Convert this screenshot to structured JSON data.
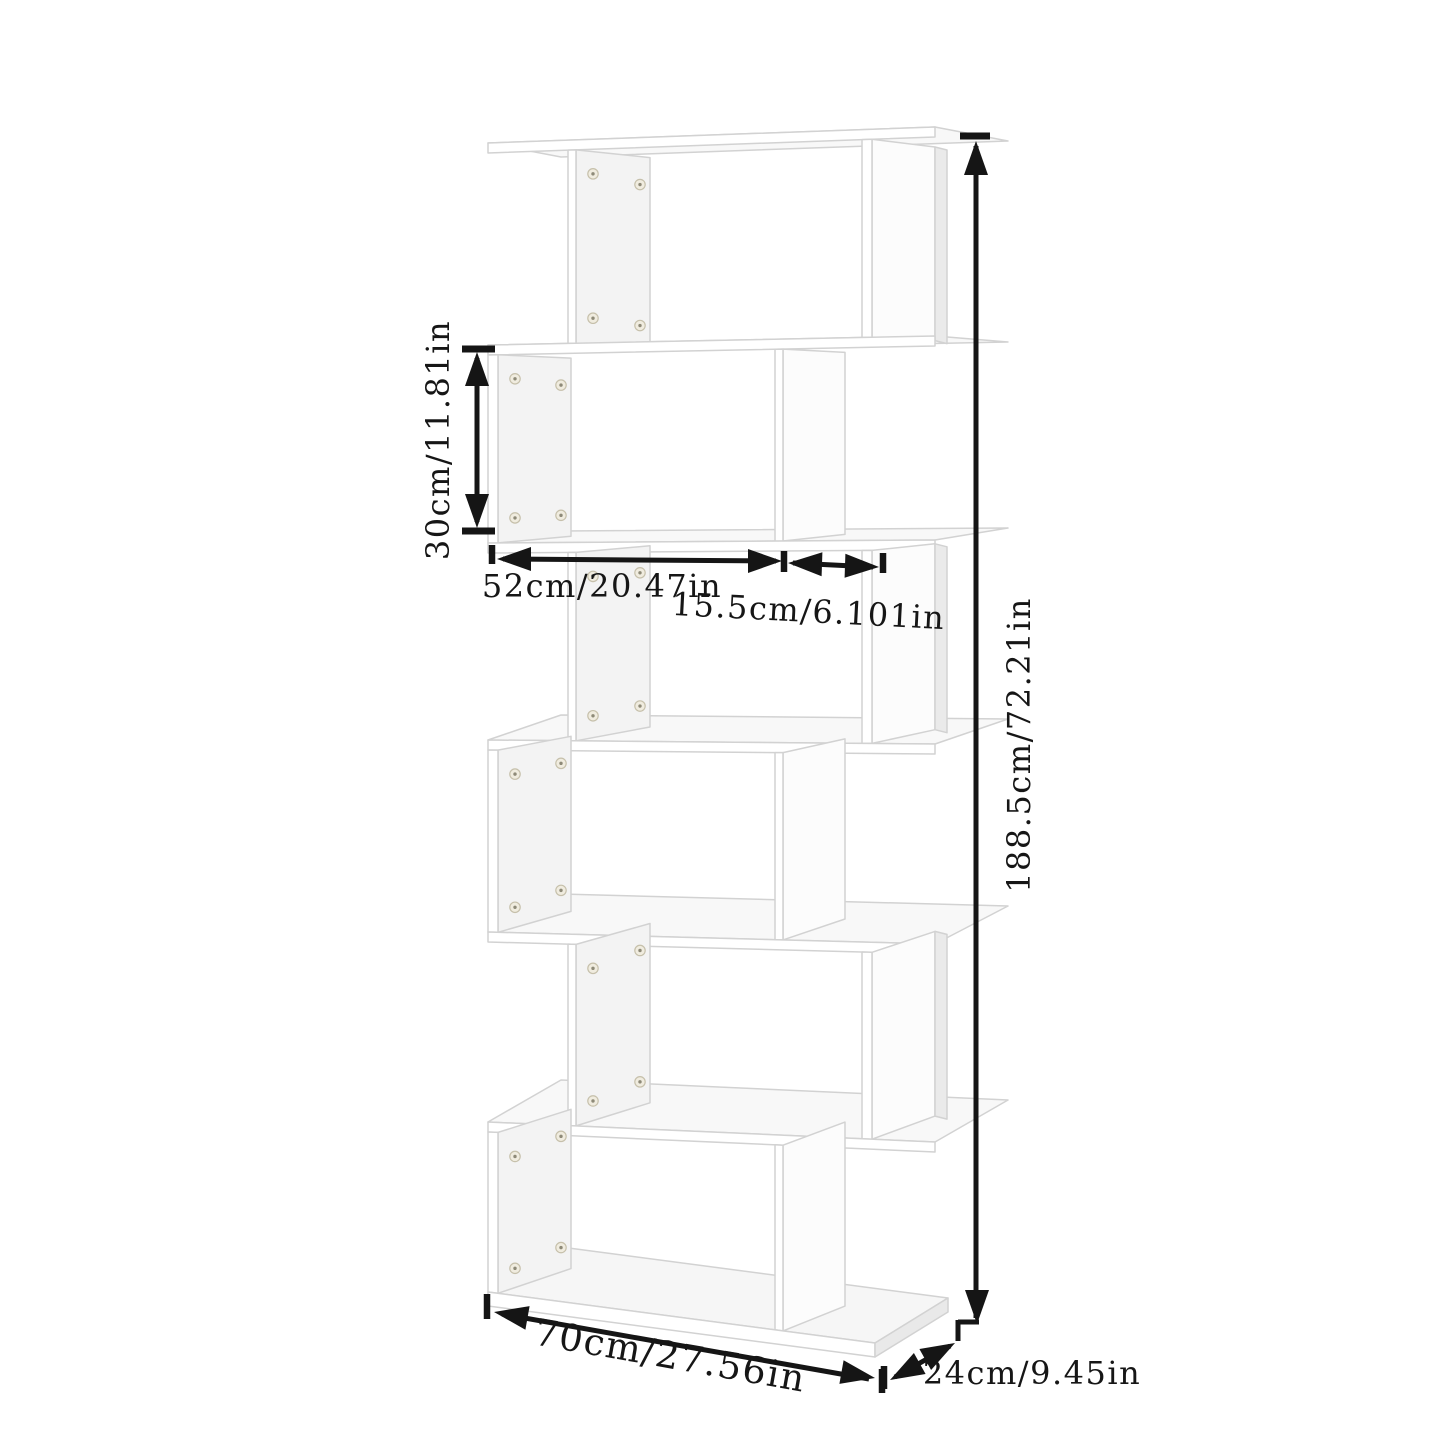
{
  "diagram": {
    "type": "product-dimension-diagram",
    "product": "s-shaped-bookcase",
    "tier_count": 6,
    "dimensions": {
      "total_height": "188.5cm/72.21in",
      "compartment_height": "30cm/11.81in",
      "shelf_width": "52cm/20.47in",
      "side_panel_width": "15.5cm/6.101in",
      "total_width": "70cm/27.56in",
      "depth": "24cm/9.45in"
    },
    "colors": {
      "background": "#ffffff",
      "furniture_fill": "#ffffff",
      "furniture_outline": "#d2d2d2",
      "panel_face": "#f3f3f3",
      "floor_face": "#f8f8f8",
      "dimension_line": "#151515",
      "screw_fill": "#f0ecdf",
      "screw_ring": "#c6c0ab"
    }
  }
}
